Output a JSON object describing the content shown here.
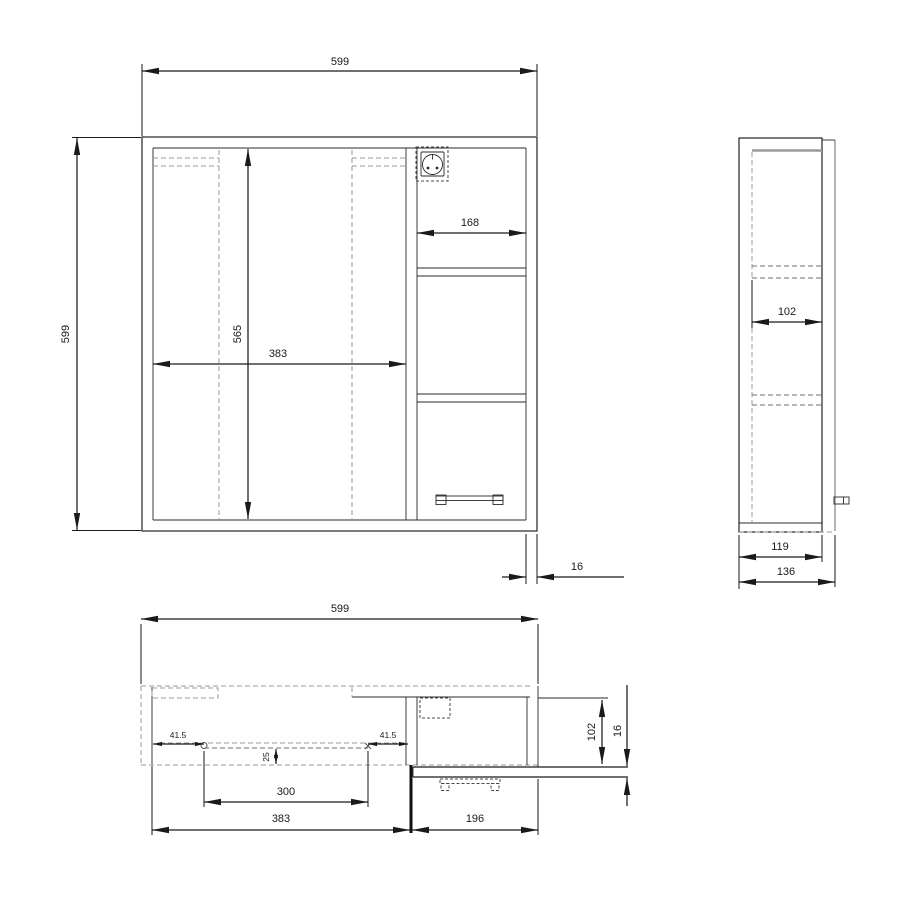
{
  "drawing": {
    "background": "#ffffff",
    "line_color": "#1a1a1a",
    "hidden_line_color": "#9a9a9a",
    "front": {
      "overall_width": "599",
      "overall_height": "599",
      "interior_height": "565",
      "left_compartment_width": "383",
      "right_compartment_width": "168",
      "side_panel_thickness": "16",
      "icons": [
        "power-socket-icon",
        "drawer-handle-icon"
      ]
    },
    "side": {
      "interior_depth": "102",
      "body_depth": "119",
      "overall_depth": "136"
    },
    "plan": {
      "overall_width": "599",
      "left_offset": "41.5",
      "right_offset": "41.5",
      "groove_offset": "25",
      "groove_width": "300",
      "left_compartment_width": "383",
      "drawer_compartment_width": "196",
      "drawer_interior_depth": "102",
      "front_panel_thickness": "16",
      "icons": [
        "drawer-handle-hidden-icon"
      ]
    }
  }
}
